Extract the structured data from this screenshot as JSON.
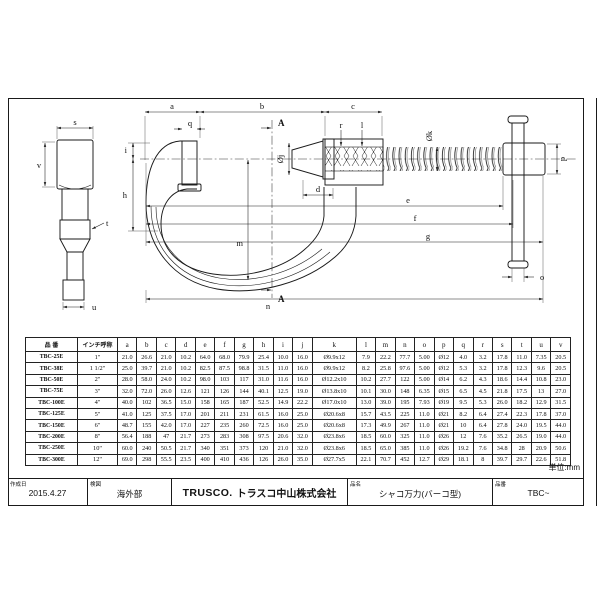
{
  "unit_note": "単位:mm",
  "drawing": {
    "dims": {
      "a": "a",
      "b": "b",
      "c": "c",
      "d": "d",
      "e": "e",
      "f": "f",
      "g": "g",
      "h": "h",
      "i": "i",
      "l": "l",
      "m": "m",
      "n": "n",
      "o": "o",
      "p": "p",
      "q": "q",
      "r": "r",
      "s": "s",
      "t": "t",
      "u": "u",
      "v": "v",
      "phi_j": "Øj",
      "phi_k": "Øk",
      "section_a": "A"
    }
  },
  "table": {
    "headers": [
      "品 番",
      "インチ呼称",
      "a",
      "b",
      "c",
      "d",
      "e",
      "f",
      "g",
      "h",
      "i",
      "j",
      "k",
      "l",
      "m",
      "n",
      "o",
      "p",
      "q",
      "r",
      "s",
      "t",
      "u",
      "v"
    ],
    "rows": [
      {
        "model": "TBC-25E",
        "inch": "1\"",
        "values": [
          "21.0",
          "26.6",
          "21.0",
          "10.2",
          "64.0",
          "68.0",
          "79.9",
          "25.4",
          "10.0",
          "16.0",
          "Ø9.9x12",
          "7.9",
          "22.2",
          "77.7",
          "5.00",
          "Ø12",
          "4.0",
          "3.2",
          "17.8",
          "11.0",
          "7.35",
          "20.5"
        ]
      },
      {
        "model": "TBC-38E",
        "inch": "1 1/2\"",
        "values": [
          "25.0",
          "39.7",
          "21.0",
          "10.2",
          "82.5",
          "87.5",
          "98.8",
          "31.5",
          "11.0",
          "16.0",
          "Ø9.9x12",
          "8.2",
          "25.8",
          "97.6",
          "5.00",
          "Ø12",
          "5.3",
          "3.2",
          "17.8",
          "12.3",
          "9.6",
          "20.5"
        ]
      },
      {
        "model": "TBC-50E",
        "inch": "2\"",
        "values": [
          "28.0",
          "58.0",
          "24.0",
          "10.2",
          "98.0",
          "103",
          "117",
          "31.0",
          "11.6",
          "16.0",
          "Ø12.2x10",
          "10.2",
          "27.7",
          "122",
          "5.00",
          "Ø14",
          "6.2",
          "4.3",
          "18.6",
          "14.4",
          "10.8",
          "23.0"
        ]
      },
      {
        "model": "TBC-75E",
        "inch": "3\"",
        "values": [
          "32.0",
          "72.0",
          "26.0",
          "12.6",
          "121",
          "126",
          "144",
          "40.1",
          "12.5",
          "19.0",
          "Ø13.8x10",
          "10.1",
          "30.0",
          "148",
          "6.35",
          "Ø15",
          "6.5",
          "4.5",
          "21.8",
          "17.5",
          "13",
          "27.0"
        ]
      },
      {
        "model": "TBC-100E",
        "inch": "4\"",
        "values": [
          "40.0",
          "102",
          "36.5",
          "15.0",
          "158",
          "165",
          "187",
          "52.5",
          "14.9",
          "22.2",
          "Ø17.0x10",
          "13.0",
          "39.0",
          "195",
          "7.93",
          "Ø19",
          "9.5",
          "5.3",
          "26.0",
          "18.2",
          "12.9",
          "31.5"
        ]
      },
      {
        "model": "TBC-125E",
        "inch": "5\"",
        "values": [
          "41.0",
          "125",
          "37.5",
          "17.0",
          "201",
          "211",
          "231",
          "61.5",
          "16.0",
          "25.0",
          "Ø20.6x8",
          "15.7",
          "43.5",
          "225",
          "11.0",
          "Ø21",
          "8.2",
          "6.4",
          "27.4",
          "22.3",
          "17.8",
          "37.0"
        ]
      },
      {
        "model": "TBC-150E",
        "inch": "6\"",
        "values": [
          "48.7",
          "155",
          "42.0",
          "17.0",
          "227",
          "235",
          "260",
          "72.5",
          "16.0",
          "25.0",
          "Ø20.6x8",
          "17.3",
          "49.9",
          "267",
          "11.0",
          "Ø21",
          "10",
          "6.4",
          "27.8",
          "24.0",
          "19.5",
          "44.0"
        ]
      },
      {
        "model": "TBC-200E",
        "inch": "8\"",
        "values": [
          "56.4",
          "188",
          "47",
          "21.7",
          "273",
          "283",
          "308",
          "97.5",
          "20.6",
          "32.0",
          "Ø23.8x6",
          "18.5",
          "60.0",
          "325",
          "11.0",
          "Ø26",
          "12",
          "7.6",
          "35.2",
          "26.5",
          "19.0",
          "44.0"
        ]
      },
      {
        "model": "TBC-250E",
        "inch": "10\"",
        "values": [
          "60.0",
          "240",
          "50.5",
          "21.7",
          "340",
          "351",
          "373",
          "120",
          "21.0",
          "32.0",
          "Ø23.8x6",
          "18.5",
          "65.0",
          "385",
          "11.0",
          "Ø26",
          "19.2",
          "7.6",
          "34.8",
          "28",
          "20.9",
          "50.6"
        ]
      },
      {
        "model": "TBC-300E",
        "inch": "12\"",
        "values": [
          "69.0",
          "298",
          "55.5",
          "23.5",
          "400",
          "410",
          "436",
          "126",
          "26.0",
          "35.0",
          "Ø27.7x5",
          "22.1",
          "70.7",
          "452",
          "12.7",
          "Ø29",
          "18.1",
          "8",
          "39.7",
          "29.7",
          "22.6",
          "51.8"
        ]
      }
    ]
  },
  "footer": {
    "created_label": "作成日",
    "created_value": "2015.4.27",
    "checked_label": "検図",
    "checked_value": "海外部",
    "brand": "TRUSCO.",
    "company": "トラスコ中山株式会社",
    "name_label": "品名",
    "name_value": "シャコ万力(バーコ型)",
    "code_label": "品番",
    "code_value": "TBC~"
  }
}
